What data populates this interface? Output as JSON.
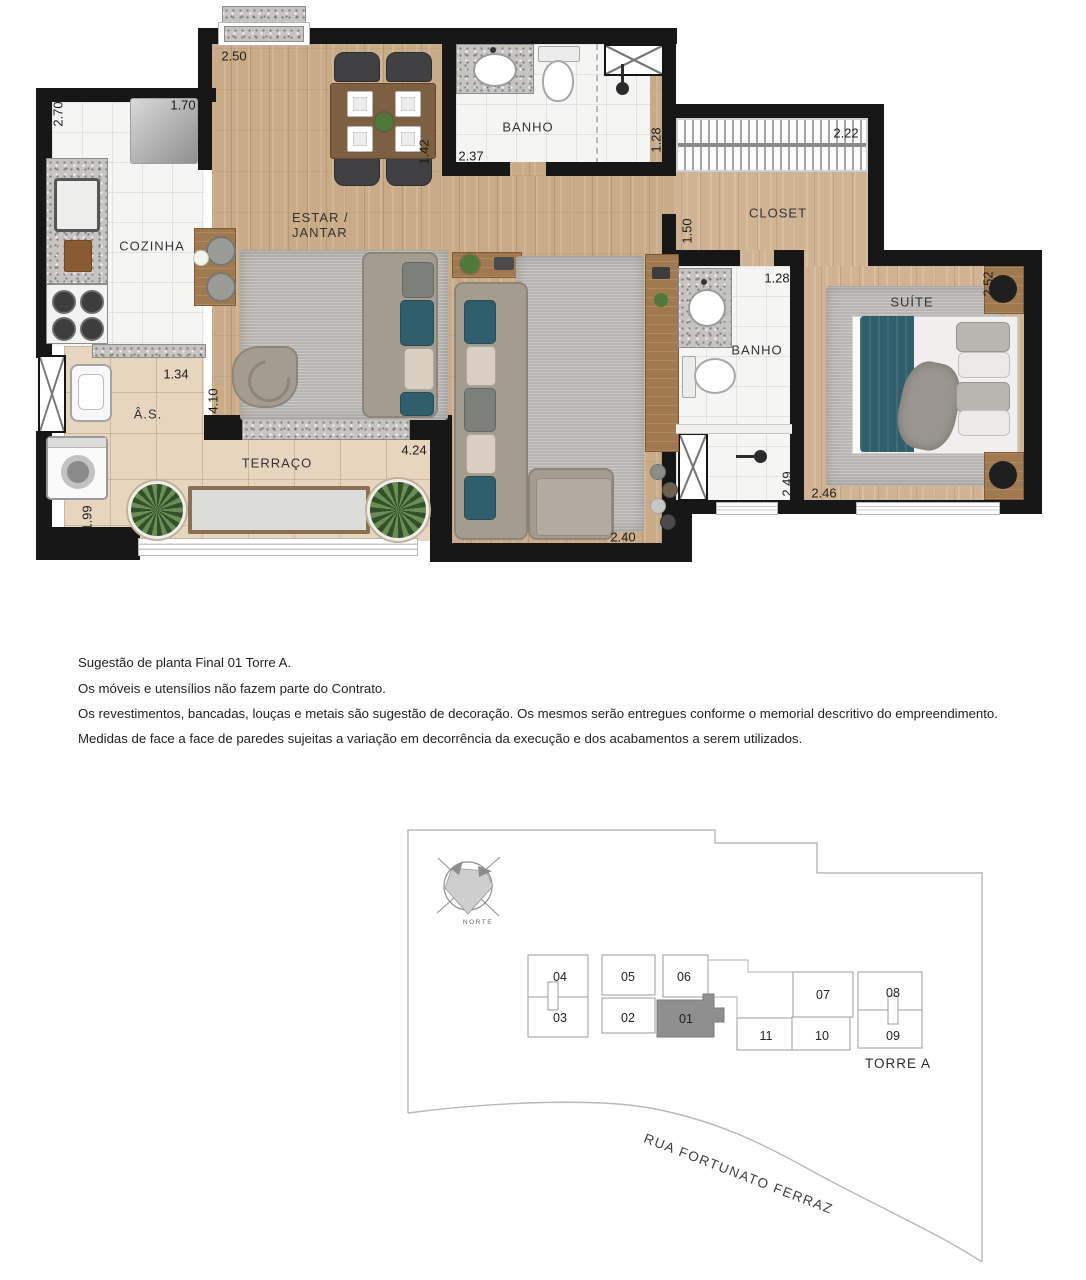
{
  "floor_plan": {
    "rooms": {
      "cozinha": "COZINHA",
      "estar_line1": "ESTAR /",
      "estar_line2": "JANTAR",
      "banho_social": "BANHO",
      "closet": "CLOSET",
      "banho_suite": "BANHO",
      "suite": "SUÍTE",
      "terraco": "TERRAÇO",
      "area_servico": "Â.S."
    },
    "dims": {
      "estar_top": "2.50",
      "cozinha_left": "2.70",
      "cozinha_top": "1.70",
      "estar_banho": "1.42",
      "banho_social_w": "2.37",
      "banho_social_shower": "1.28",
      "closet_top": "2.22",
      "closet_left": "1.50",
      "banho_suite_top": "1.28",
      "suite_right": "2.52",
      "as_top": "1.34",
      "estar_left_h": "4.10",
      "terraco_w": "4.24",
      "banho_suite_shower": "2.49",
      "suite_bottom": "2.46",
      "as_left_h": "1.99",
      "estar_bottom": "2.40"
    },
    "colors": {
      "wall": "#171717",
      "wood_floor": "#c9ab87",
      "accent_teal": "#2f5f6b"
    }
  },
  "notes": {
    "line1": "Sugestão de planta Final 01 Torre A.",
    "line2": "Os móveis e utensílios não fazem parte do Contrato.",
    "line3": "Os revestimentos, bancadas, louças e metais são sugestão de decoração. Os mesmos serão entregues conforme o memorial descritivo do empreendimento.",
    "line4": "Medidas de face a face de paredes sujeitas a variação em decorrência da execução e dos acabamentos a serem utilizados."
  },
  "site_plan": {
    "north_label": "NORTE",
    "tower_label": "TORRE A",
    "street_label": "RUA FORTUNATO FERRAZ",
    "highlighted_unit": "01",
    "highlight_color": "#8f8f8f",
    "units": {
      "u04": "04",
      "u05": "05",
      "u06": "06",
      "u03": "03",
      "u02": "02",
      "u01": "01",
      "u07": "07",
      "u08": "08",
      "u11": "11",
      "u10": "10",
      "u09": "09"
    }
  }
}
